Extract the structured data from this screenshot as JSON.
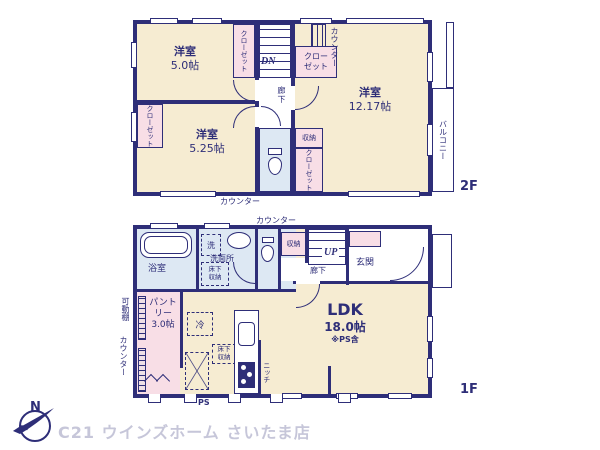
{
  "colors": {
    "wall": "#2e2e78",
    "room_fill": "#f6ecd2",
    "closet_fill": "#f8dee6",
    "wet_fill": "#dde8f3",
    "caption_text": "#c6c6d9"
  },
  "caption": {
    "brand": "C21 ウインズホーム さいたま店",
    "compass_n": "N"
  },
  "floor2": {
    "tag": "2F",
    "bed1": {
      "name": "洋室",
      "size": "5.0帖"
    },
    "bed2": {
      "name": "洋室",
      "size": "5.25帖"
    },
    "bed3": {
      "name": "洋室",
      "size": "12.17帖"
    },
    "closet_top_strip": "クローゼット",
    "closet_mid_box": "クローゼット",
    "closet_left_box": "クローゼット",
    "closet_bottom_box": "クローゼット",
    "storage": "収納",
    "counter_top": "カウンター",
    "counter_bottom": "カウンター",
    "corridor": "廊下",
    "stairs": "DN",
    "balcony": "バルコニー"
  },
  "floor1": {
    "tag": "1F",
    "ldk": {
      "name": "LDK",
      "size": "18.0帖",
      "note": "※PS含"
    },
    "pantry": {
      "name": "パントリー",
      "size": "3.0帖"
    },
    "bath": "浴室",
    "washroom": "洗面所",
    "washer": "洗",
    "underfloor_wash": "床下収納",
    "underfloor_kitchen": "床下収納",
    "storage": "収納",
    "entrance": "玄関",
    "corridor": "廊下",
    "stairs": "UP",
    "counter_top": "カウンター",
    "counter_left": "カウンター",
    "movable_shelf": "可動棚",
    "fridge": "冷",
    "niche": "ニッチ",
    "ps": "PS"
  }
}
